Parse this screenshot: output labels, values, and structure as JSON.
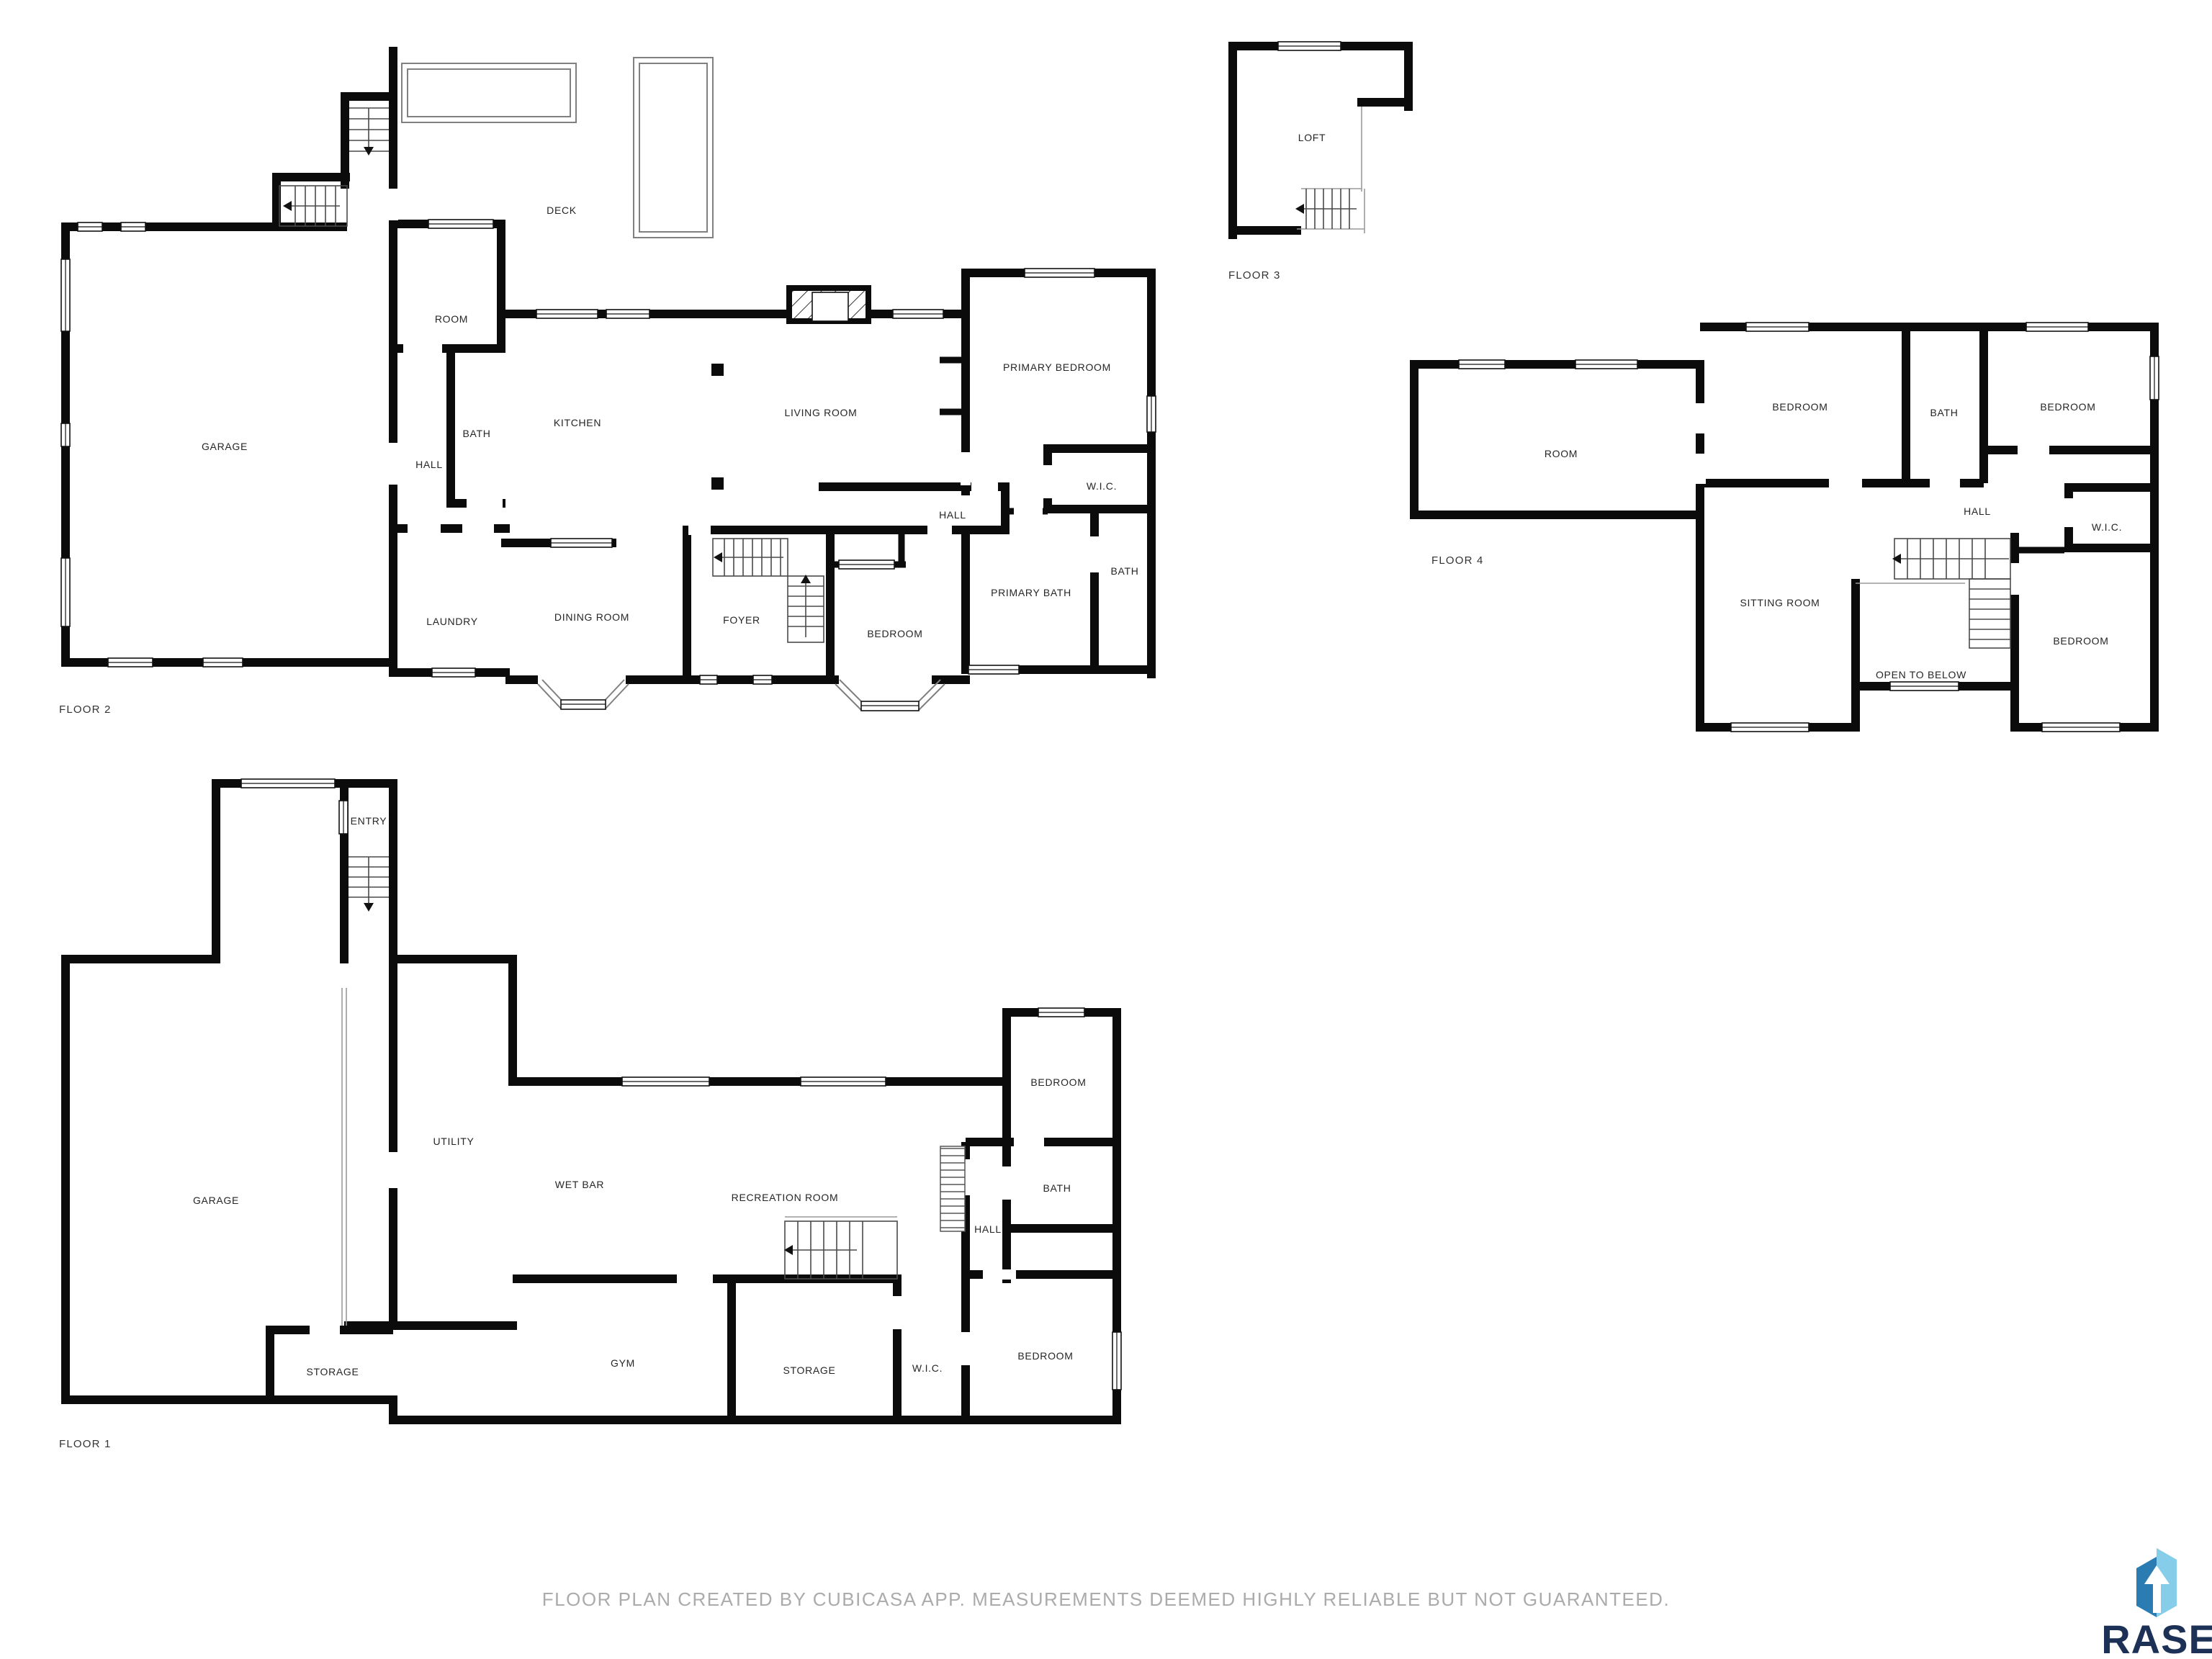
{
  "document": {
    "type": "floor-plan",
    "creator_note": "FLOOR PLAN CREATED BY CUBICASA APP. MEASUREMENTS DEEMED HIGHLY RELIABLE BUT NOT GUARANTEED."
  },
  "floors": [
    {
      "name": "FLOOR 2",
      "rooms": [
        "GARAGE",
        "ROOM",
        "DECK",
        "BATH",
        "HALL",
        "KITCHEN",
        "LIVING ROOM",
        "PRIMARY BEDROOM",
        "HALL",
        "W.I.C.",
        "PRIMARY BATH",
        "BATH",
        "BEDROOM",
        "FOYER",
        "DINING ROOM",
        "LAUNDRY"
      ]
    },
    {
      "name": "FLOOR 3",
      "rooms": [
        "LOFT"
      ]
    },
    {
      "name": "FLOOR 4",
      "rooms": [
        "ROOM",
        "BEDROOM",
        "BATH",
        "BEDROOM",
        "HALL",
        "W.I.C.",
        "SITTING ROOM",
        "OPEN TO BELOW",
        "BEDROOM"
      ]
    },
    {
      "name": "FLOOR 1",
      "rooms": [
        "ENTRY",
        "GARAGE",
        "UTILITY",
        "WET BAR",
        "RECREATION ROOM",
        "BEDROOM",
        "BATH",
        "HALL",
        "GYM",
        "STORAGE",
        "W.I.C.",
        "BEDROOM",
        "STORAGE"
      ]
    }
  ],
  "footer": {
    "disclaimer": "FLOOR PLAN CREATED BY CUBICASA APP. MEASUREMENTS DEEMED HIGHLY RELIABLE BUT NOT GUARANTEED."
  },
  "brand": {
    "name": "RASE",
    "colors": {
      "icon_dark": "#2a7cb2",
      "icon_light": "#85cde9",
      "text": "#1d3156",
      "wall": "#0b0b0b",
      "disclaimer": "#ababab"
    }
  }
}
